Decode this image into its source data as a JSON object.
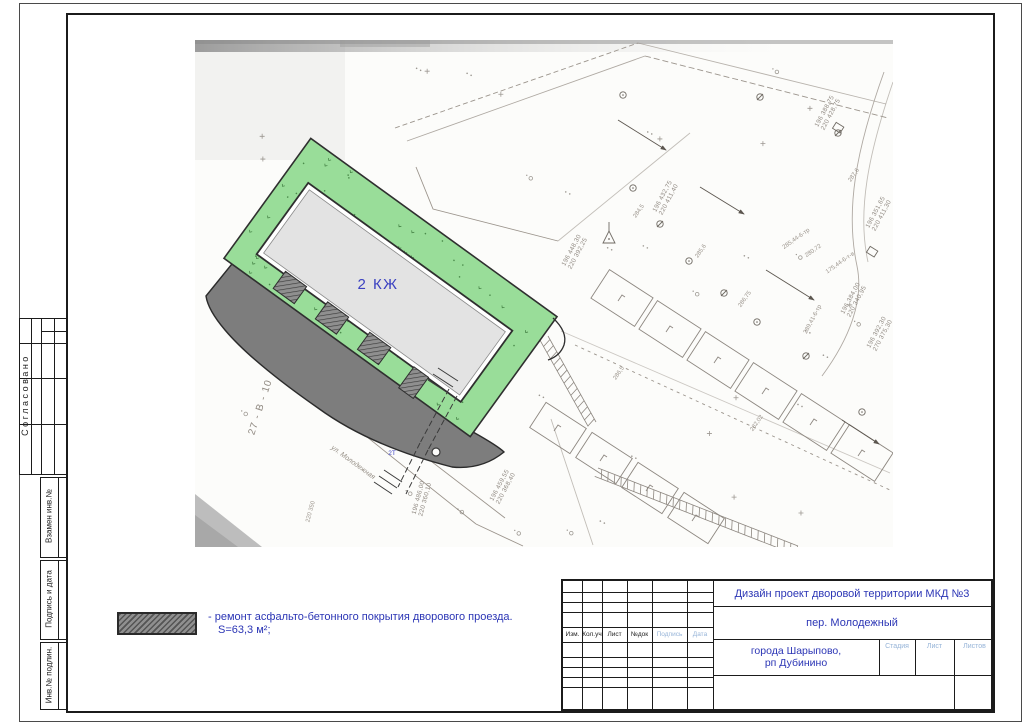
{
  "sheet": {
    "side_stamp": {
      "approved": "Согласовано",
      "replace_inv": "Взамен инв.№",
      "sign_date": "Подпись и дата",
      "inv_original": "Инв.№ подлин."
    },
    "legend": {
      "line1": "- ремонт асфальто-бетонного покрытия дворового проезда.",
      "line2": "S=63,3 м²;"
    },
    "title_block": {
      "project_title": "Дизайн проект дворовой территории МКД №3",
      "object_address": "пер. Молодежный",
      "location_line1": "города Шарыпово,",
      "location_line2": "рп Дубинино",
      "revision_columns": [
        "Изм.",
        "Кол.уч",
        "Лист",
        "№док",
        "Подпись",
        "Дата"
      ],
      "stage_label": "Стадия",
      "sheet_label": "Лист",
      "sheets_label": "Листов"
    },
    "plan": {
      "building_label": "2 КЖ",
      "utility_point_label": "2Т",
      "parcel_label": "27 - В - 10",
      "street_label": "ул. Молодежная",
      "coord_labels": [
        {
          "l1": "196 448,30",
          "l2": "220 392,25",
          "x": 573,
          "y": 251,
          "rot": -62
        },
        {
          "l1": "196 432,75",
          "l2": "220 411,40",
          "x": 664,
          "y": 197,
          "rot": -62
        },
        {
          "l1": "196 388,75",
          "l2": "220 428,75",
          "x": 826,
          "y": 112,
          "rot": -62
        },
        {
          "l1": "196 351,65",
          "l2": "220 411,30",
          "x": 877,
          "y": 213,
          "rot": -62
        },
        {
          "l1": "196 384,00",
          "l2": "220 340,95",
          "x": 852,
          "y": 299,
          "rot": -62
        },
        {
          "l1": "196 392,30",
          "l2": "270 375,30",
          "x": 878,
          "y": 333,
          "rot": -62
        },
        {
          "l1": "196 486,00",
          "l2": "220 360,10",
          "x": 420,
          "y": 498,
          "rot": -75
        },
        {
          "l1": "196 459,55",
          "l2": "220 368,40",
          "x": 501,
          "y": 486,
          "rot": -62
        }
      ],
      "elevation_labels": [
        {
          "t": "284,5",
          "x": 640,
          "y": 212,
          "rot": -55
        },
        {
          "t": "285,6",
          "x": 702,
          "y": 252,
          "rot": -55
        },
        {
          "t": "286,75",
          "x": 746,
          "y": 300,
          "rot": -55
        },
        {
          "t": "280,72",
          "x": 814,
          "y": 252,
          "rot": -35
        },
        {
          "t": "287,6",
          "x": 855,
          "y": 176,
          "rot": -55
        },
        {
          "t": "285,44-6-тр",
          "x": 797,
          "y": 240,
          "rot": -35
        },
        {
          "t": "175,44-6-т-в",
          "x": 841,
          "y": 264,
          "rot": -35
        },
        {
          "t": "289,41-6-тр",
          "x": 814,
          "y": 320,
          "rot": -62
        },
        {
          "t": "286,5",
          "x": 620,
          "y": 374,
          "rot": -55
        },
        {
          "t": "282,02",
          "x": 758,
          "y": 424,
          "rot": -55
        },
        {
          "t": "220 350",
          "x": 312,
          "y": 512,
          "rot": -75
        }
      ]
    },
    "colors": {
      "accent_blue": "#2b35b5",
      "stamp_hint_blue": "#96b4d8",
      "lawn_green": "#99dd99",
      "asphalt_gray": "#7d7d7d",
      "building_gray": "#e3e3e3"
    }
  }
}
